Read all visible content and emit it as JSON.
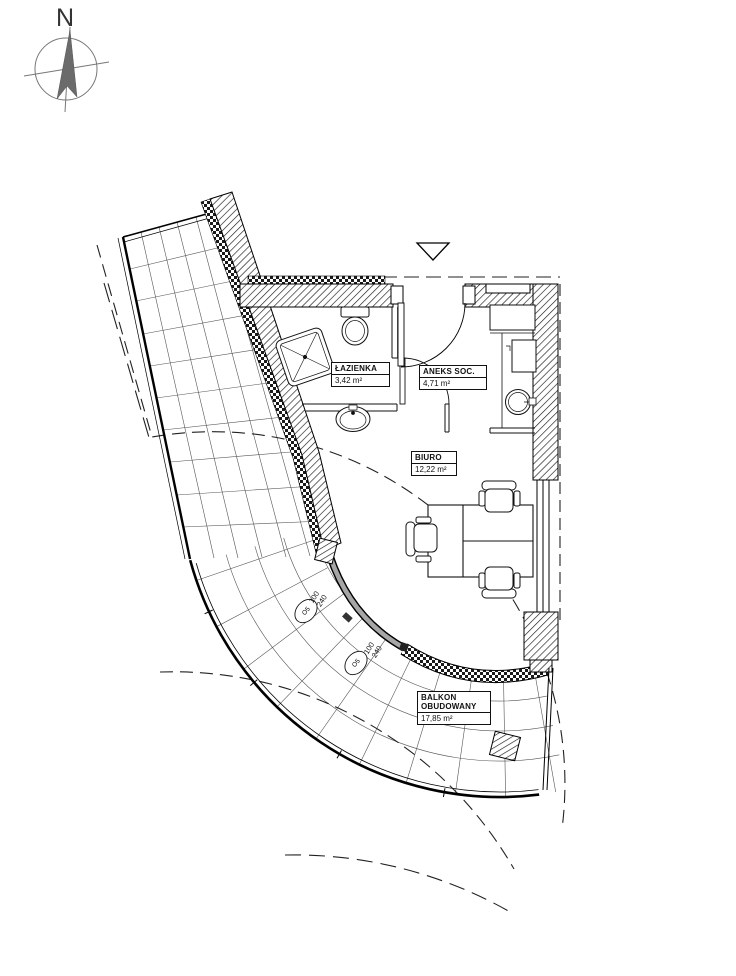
{
  "compass": {
    "north_label": "N"
  },
  "rooms": {
    "lazienka": {
      "name": "ŁAZIENKA",
      "area": "3,42 m²"
    },
    "aneks": {
      "name": "ANEKS SOC.",
      "area": "4,71 m²"
    },
    "biuro": {
      "name": "BIURO",
      "area": "12,22 m²"
    },
    "balkon": {
      "name": "BALKON OBUDOWANY",
      "area": "17,85 m²"
    }
  },
  "windows": [
    {
      "marker": "O5",
      "width": "100",
      "height": "240"
    },
    {
      "marker": "O5",
      "width": "100",
      "height": "240"
    }
  ]
}
